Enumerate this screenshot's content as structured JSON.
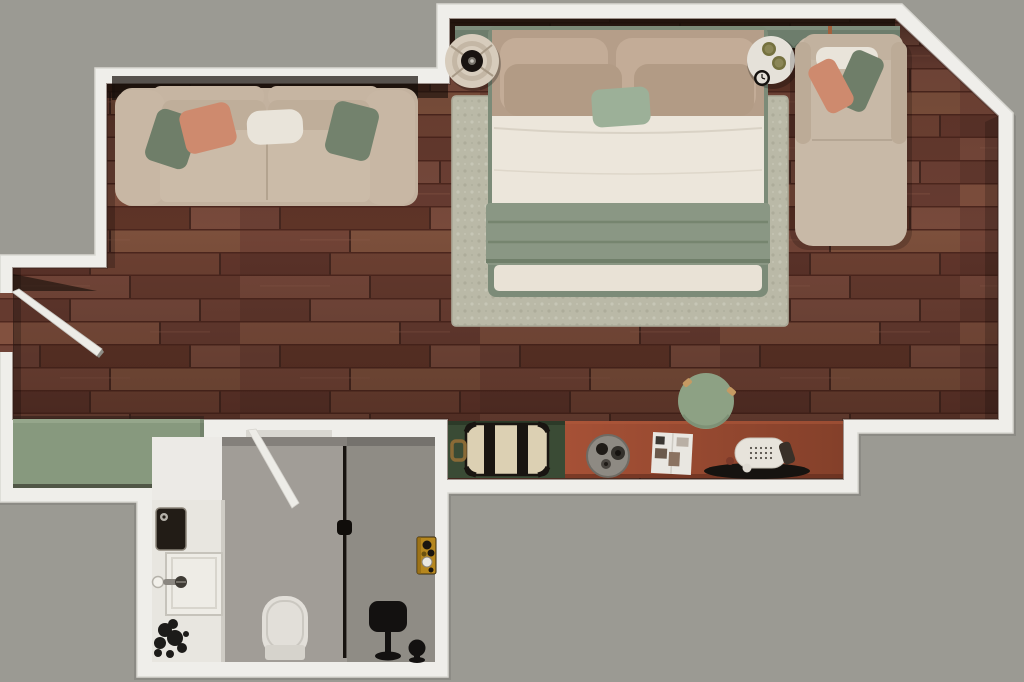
{
  "scene": {
    "title": "Studio apartment top-down 3D floor plan render",
    "view": "top-down",
    "rooms": [
      {
        "id": "bedroom-living",
        "floor": "hardwood-parquet"
      },
      {
        "id": "bed-alcove",
        "floor": "hardwood-parquet",
        "wall": "angled-top-right"
      },
      {
        "id": "bathroom",
        "floor": "gray-stone",
        "zones": [
          "vanity",
          "toilet",
          "shower"
        ]
      },
      {
        "id": "wardrobe-nook",
        "floor": "green-cabinet-top"
      },
      {
        "id": "entry",
        "feature": "open-door-into-room"
      }
    ],
    "furniture": [
      {
        "id": "double-bed",
        "items": [
          "beige-pillows",
          "sage-accent-pillow",
          "white-duvet",
          "sage-throw-blanket",
          "green-upholstered-frame"
        ]
      },
      {
        "id": "headboard-shelf",
        "accent": "leather-straps"
      },
      {
        "id": "area-rug",
        "style": "boucle-cream"
      },
      {
        "id": "round-tray-nightstand",
        "side": "left-of-bed"
      },
      {
        "id": "round-side-table",
        "side": "right-of-bed",
        "items": [
          "two-olive-cups",
          "alarm-clock"
        ]
      },
      {
        "id": "chaise-lounge",
        "items": [
          "white-bolster",
          "green-pillow",
          "coral-pillow"
        ]
      },
      {
        "id": "three-seat-sofa",
        "items": [
          "green-pillow",
          "coral-pillow",
          "white-bolster",
          "green-pillow"
        ]
      },
      {
        "id": "luggage-bench",
        "items": [
          "vintage-trunk"
        ]
      },
      {
        "id": "writing-desk",
        "items": [
          "serving-tray",
          "open-magazine",
          "vintage-telephone",
          "black-oval-tray"
        ]
      },
      {
        "id": "desk-stool",
        "style": "round-sage"
      },
      {
        "id": "wardrobe-cabinet"
      },
      {
        "id": "vanity-counter",
        "items": [
          "washbasin",
          "faucet",
          "wall-sink-box",
          "potted-plant"
        ]
      },
      {
        "id": "toilet"
      },
      {
        "id": "shower-partition"
      },
      {
        "id": "shower-head-stand"
      },
      {
        "id": "shower-stool"
      },
      {
        "id": "shower-controls",
        "style": "brass-panel"
      },
      {
        "id": "entry-door",
        "state": "open"
      },
      {
        "id": "bathroom-door",
        "state": "open"
      }
    ]
  },
  "palette": {
    "outside": "#9b9a93",
    "wall": "#efeeea",
    "wall_edge": "#d9d8d2",
    "wood_base": "#6e4136",
    "rug": "#c5c4b2",
    "bed_frame": "#7c8b78",
    "duvet": "#ece6db",
    "blanket": "#8a9784",
    "bed_footer": "#e9e2d6",
    "pillow_beige": "#c3ac97",
    "pillow_tan": "#b29b85",
    "pillow_sage": "#9cb098",
    "headboard_shelf": "#6d7d6c",
    "strap_orange": "#a2603c",
    "sofa": "#c3b29f",
    "cushion": "#cbbba8",
    "pillow_green": "#6f7e69",
    "pillow_coral": "#ce8a6e",
    "bolster_white": "#e9e4da",
    "chaise": "#c8b9a7",
    "nightstand_cream": "#d7ccbc",
    "nightstand_dark": "#191310",
    "side_table_white": "#e5e1d9",
    "cup_olive": "#75713f",
    "clock_black": "#14110e",
    "bench_green": "#3a4b35",
    "trunk_cream": "#dcd0b3",
    "trunk_black": "#191511",
    "handle_brass": "#8a6a36",
    "desk_terracotta": "#9c4a30",
    "tray_gray": "#8e8a83",
    "magazine_white": "#e9e7e1",
    "phone_white": "#e7e3db",
    "tray_black": "#161310",
    "stool_green": "#8da184",
    "wardrobe_green": "#87997e",
    "bath_floor": "#a19d97",
    "shower_floor": "#8f8c85",
    "vanity_white": "#e8e6e0",
    "sink_black": "#221c16",
    "fixture_black": "#131110",
    "panel_gold": "#b6871e",
    "toilet_white": "#e2dfd9",
    "door_white": "#edece7"
  }
}
